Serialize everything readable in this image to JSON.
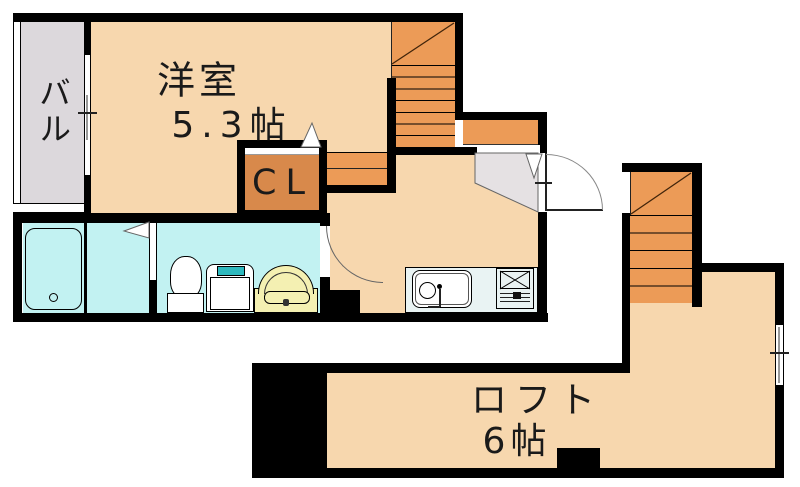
{
  "title": "apartment-floor-plan",
  "colors": {
    "wall": "#000000",
    "floor": "#F7D7AE",
    "stairs": "#EC9B57",
    "closet": "#D8894B",
    "balcony": "#DCD8DC",
    "genkan": "#E5E1E3",
    "bathroom": "#C2F2F2",
    "counter": "#E9F3F3",
    "teal": "#2FB9BE",
    "basin_yellow": "#F4F0B2",
    "text": "#1A1A1A"
  },
  "rooms": {
    "main": {
      "name": "洋室",
      "size": "5.3帖"
    },
    "balcony": {
      "name": "バル"
    },
    "closet": {
      "name": "CL"
    },
    "loft": {
      "name": "ロフト",
      "size": "6帖"
    }
  },
  "fixtures": [
    "bathtub",
    "toilet",
    "washing-machine",
    "washbasin",
    "kitchen-sink",
    "gas-stove",
    "staircase",
    "loft-staircase",
    "entrance-door",
    "washroom-door",
    "bathroom-door",
    "balcony-window",
    "loft-window"
  ]
}
